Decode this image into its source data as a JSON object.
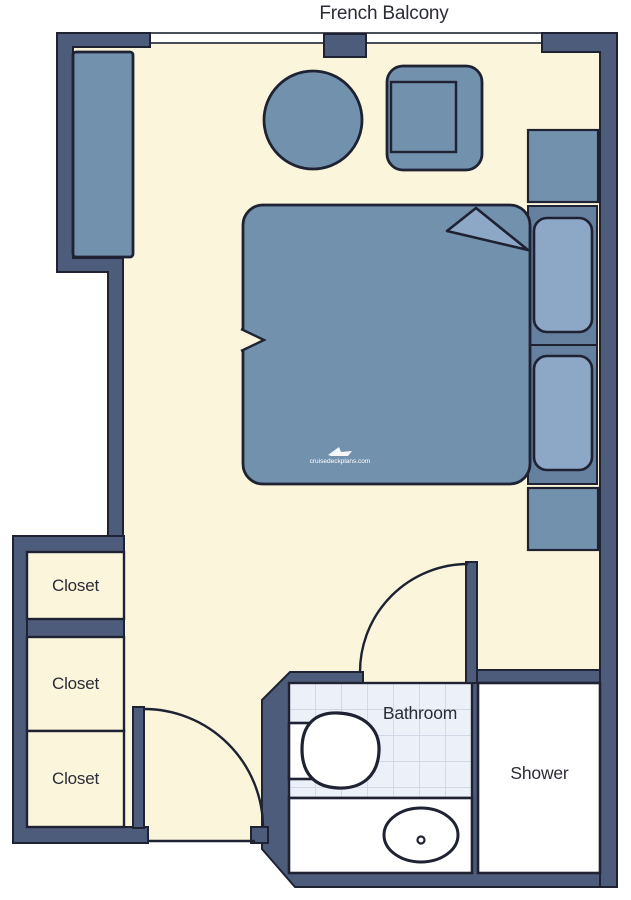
{
  "title": "French Balcony",
  "labels": {
    "closets": [
      "Closet",
      "Closet",
      "Closet"
    ],
    "bathroom": "Bathroom",
    "shower": "Shower"
  },
  "watermark": "cruisedeckplans.com",
  "colors": {
    "wall": "#4E5C7B",
    "outline": "#1E2233",
    "floor": "#FBF5DB",
    "furniture": "#7291AD",
    "pillow": "#8DA8C6",
    "headboard": "#65819F",
    "tile": "#ECF0F8",
    "tile_grid": "#C8D1E0",
    "fixture": "#FFFFFF",
    "text": "#2B2C35"
  }
}
